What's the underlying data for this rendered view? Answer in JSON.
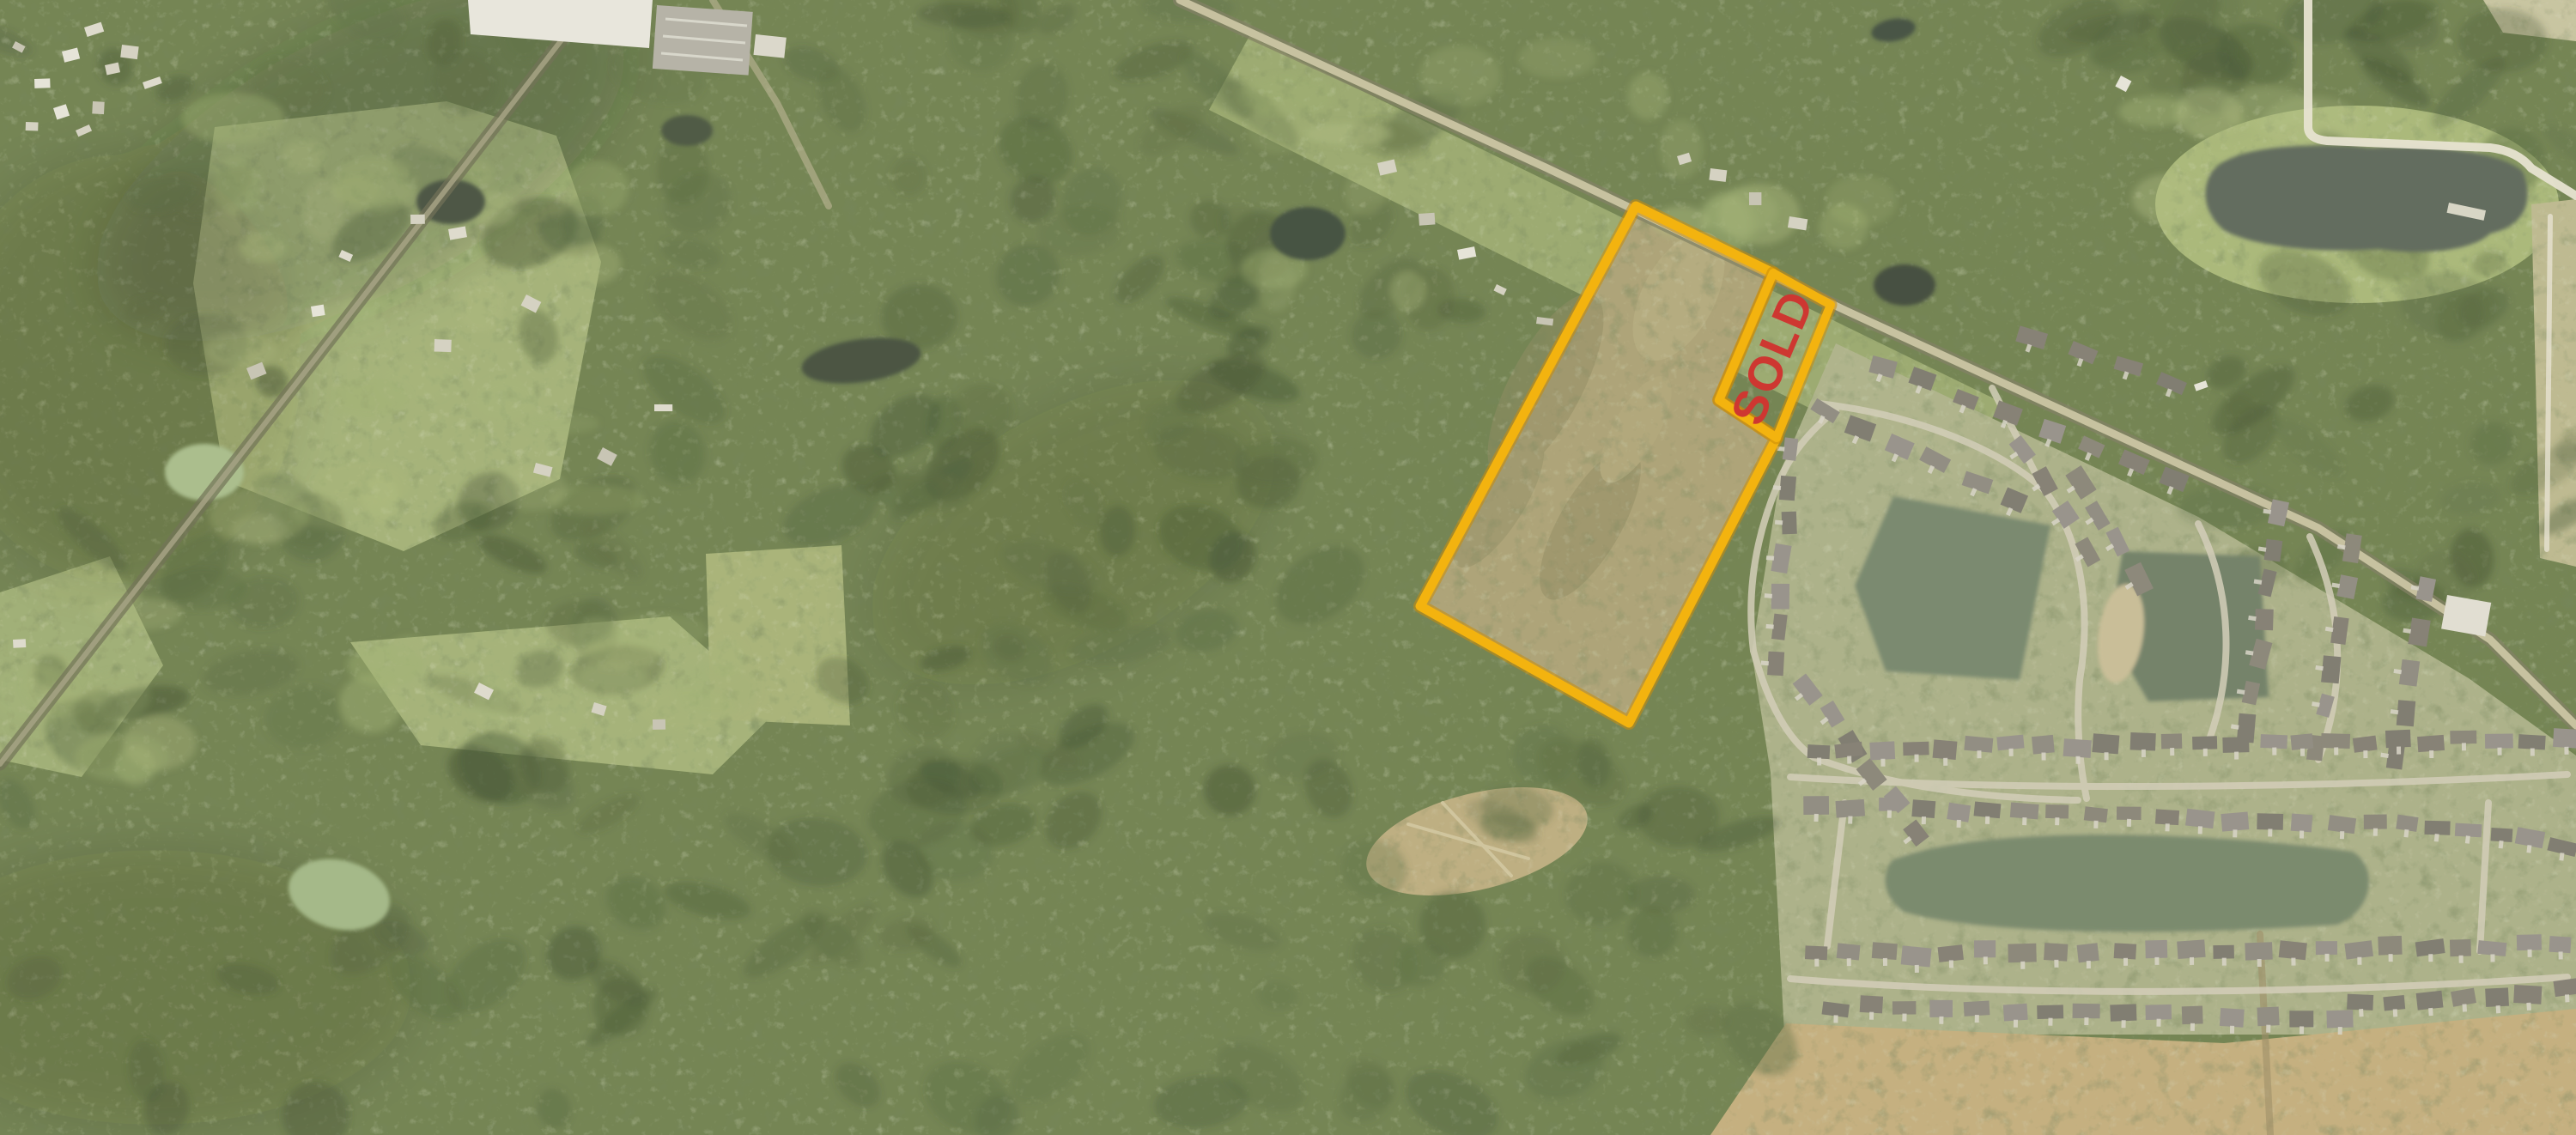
{
  "annotations": {
    "sold_label": "SOLD",
    "sold_text_color": "#ce2f2a",
    "boundary_color": "#f5b106",
    "boundary_edge_color": "#c98900"
  }
}
